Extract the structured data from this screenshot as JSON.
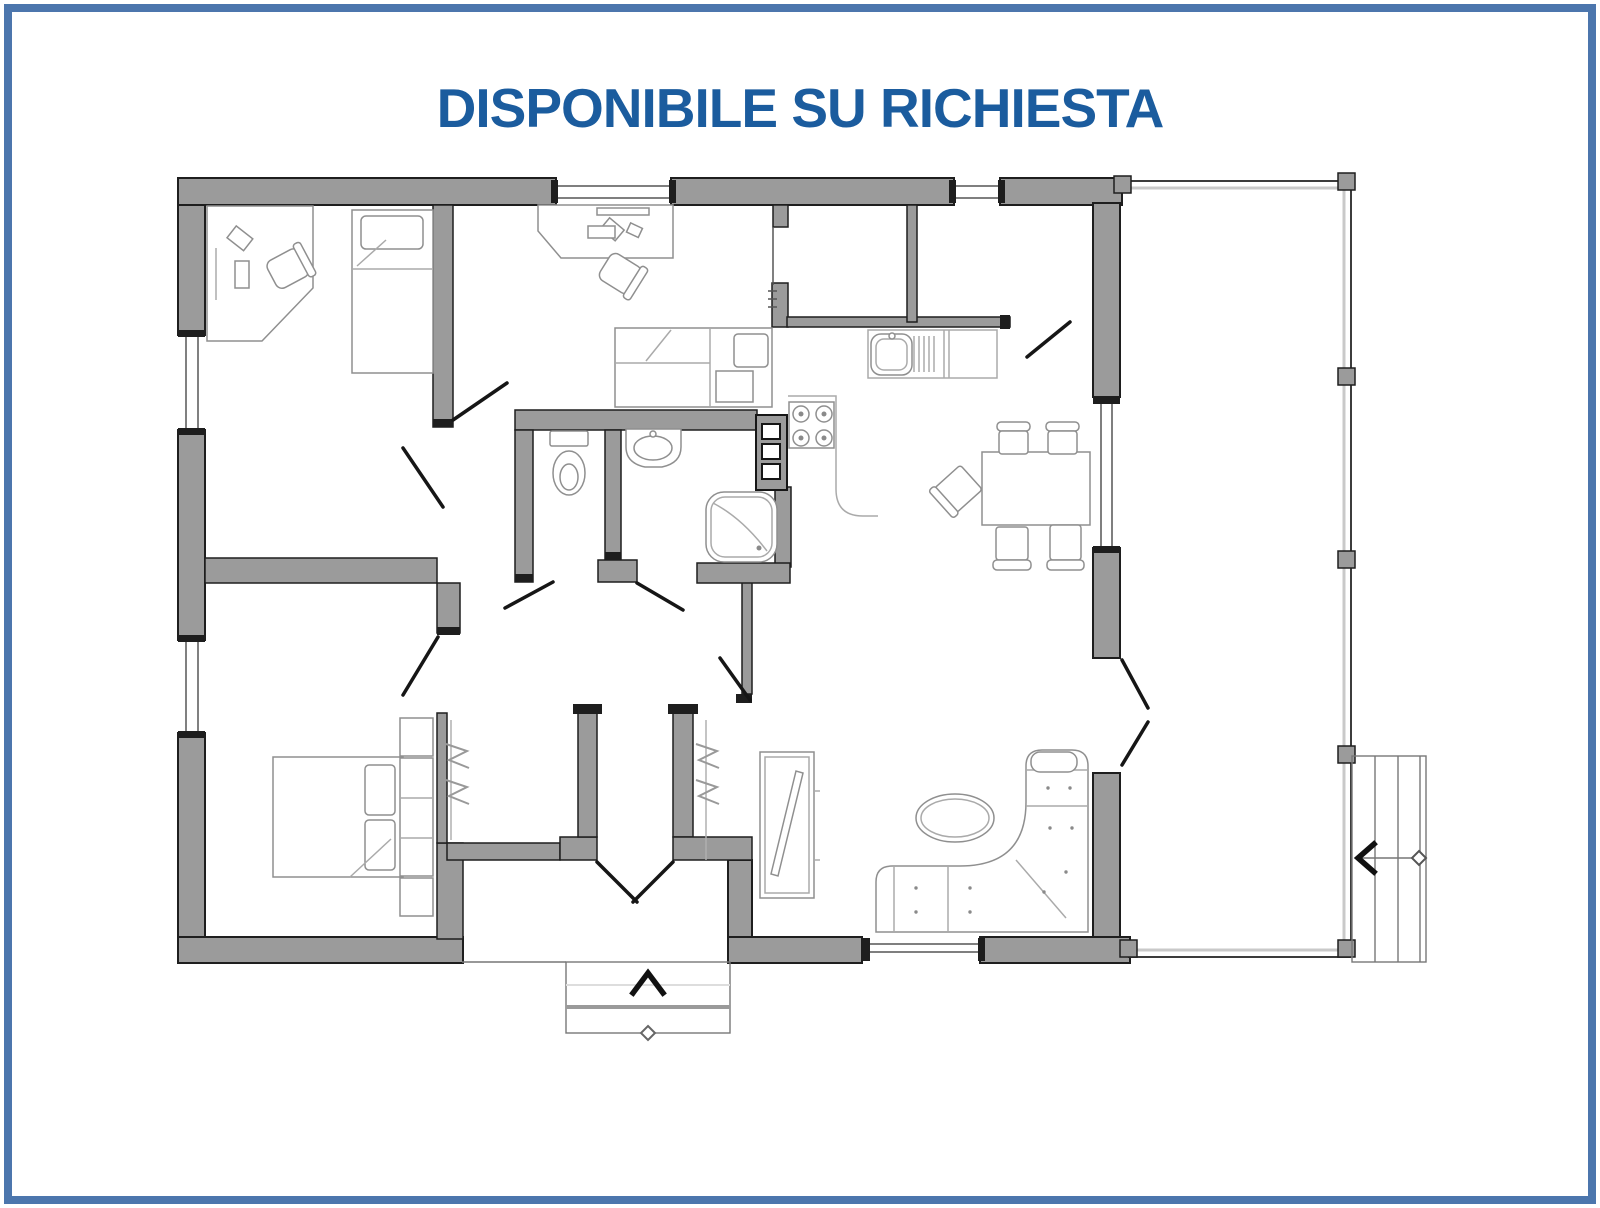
{
  "page": {
    "title": "DISPONIBILE SU RICHIESTA"
  },
  "colors": {
    "border": "#4c76ad",
    "title": "#1b5c9e",
    "wall_fill": "#9b9b9b",
    "wall_edge": "#1e1e1e",
    "thin_line": "#555555",
    "furniture_line": "#8f8f8f",
    "light_line": "#aaaaaa",
    "background": "#ffffff"
  },
  "plan": {
    "type": "single-storey house floor plan",
    "arrows": {
      "entry": "chevron-up",
      "stairs": "chevron-left"
    },
    "icons": [
      "office-desk-icon",
      "office-chair-icon",
      "single-bed-icon",
      "bedroom-desk-icon",
      "bedroom-chair-icon",
      "double-bed-icon",
      "headboard-cabinets-icon",
      "wardrobe-rail-icon",
      "toilet-icon",
      "washbasin-icon",
      "shower-icon",
      "kitchen-sink-icon",
      "drainer-icon",
      "stove-icon",
      "appliance-column-icon",
      "dining-table-icon",
      "dining-chair-icon",
      "corner-sofa-icon",
      "coffee-table-icon",
      "tv-sideboard-icon",
      "terrace-post-icon",
      "external-stairs-icon",
      "entry-steps-icon"
    ]
  }
}
